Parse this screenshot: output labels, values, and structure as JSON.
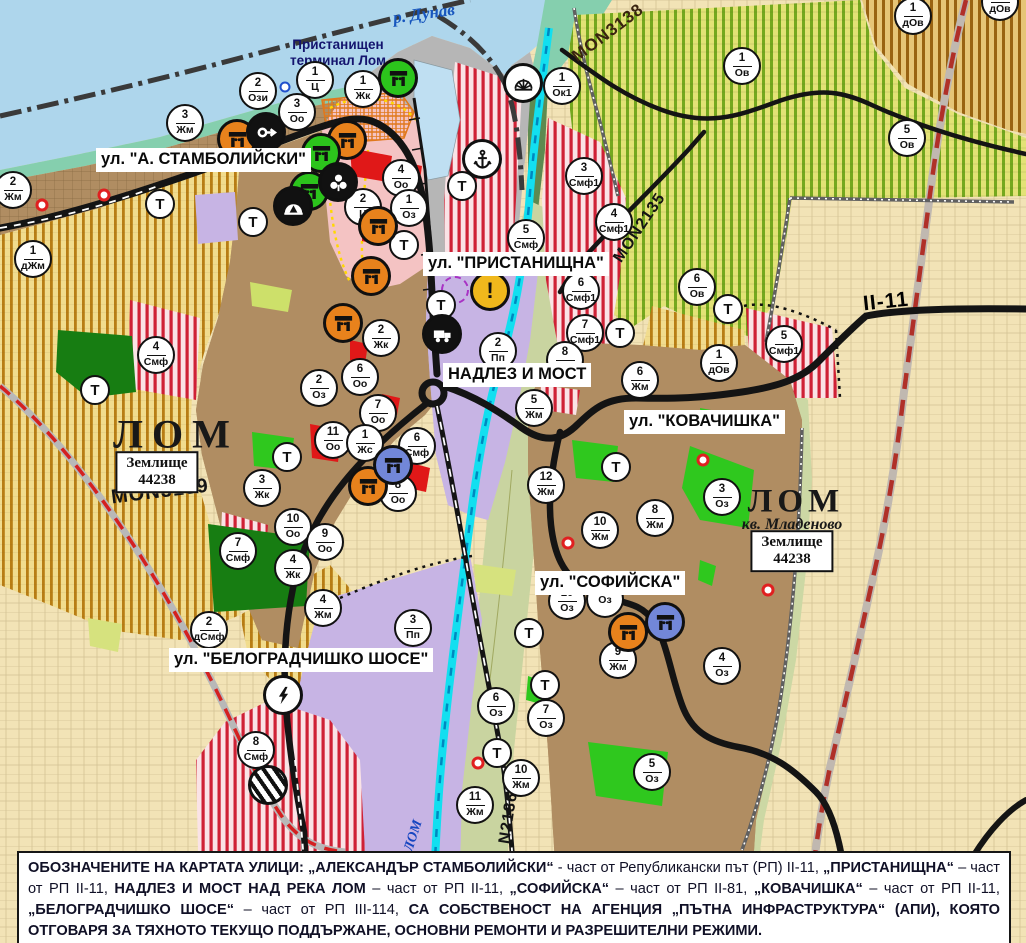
{
  "colors": {
    "water": "#aed6ec",
    "shore": "#85cfae",
    "port_gray": "#b6b6b6",
    "urban_brown": "#b08d62",
    "purple": "#c7b4e4",
    "beige": "#f2e3b6",
    "olive": "#c9d4a0",
    "cyan_river": "#12dff0",
    "red_patch": "#e01818",
    "green_patch": "#2fc81e",
    "dark_green": "#177d12",
    "marker_orange": "#e8821c",
    "marker_green": "#2cc41c",
    "marker_blue": "#7287d8",
    "marker_black": "#111111",
    "marker_yellow": "#f0b81c"
  },
  "water_labels": {
    "danube": "р. Дунав",
    "lom_river": "ЛОМ"
  },
  "labels": {
    "port_terminal": "Пристанищен\nтерминал Лом",
    "lom_left": "ЛОМ",
    "lom_right": "ЛОМ",
    "kv_mladenovo": "кв. Младеново",
    "zemlishte_line1": "Землище",
    "zemlishte_line2": "44238"
  },
  "street_labels": [
    {
      "id": "stamboliyski",
      "text": "ул. \"А. СТАМБОЛИЙСКИ\"",
      "x": 96,
      "y": 148
    },
    {
      "id": "pristanishtna",
      "text": "ул. \"ПРИСТАНИЩНА\"",
      "x": 423,
      "y": 252
    },
    {
      "id": "nadlez",
      "text": "НАДЛЕЗ И МОСТ",
      "x": 443,
      "y": 363
    },
    {
      "id": "kovachishka",
      "text": "ул. \"КОВАЧИШКА\"",
      "x": 624,
      "y": 410
    },
    {
      "id": "sofiyska",
      "text": "ул. \"СОФИЙСКА\"",
      "x": 535,
      "y": 571
    },
    {
      "id": "belogradchishko",
      "text": "ул. \"БЕЛОГРАДЧИШКО ШОСЕ\"",
      "x": 169,
      "y": 648
    }
  ],
  "road_labels": [
    {
      "text": "MON3138",
      "x": 608,
      "y": 33,
      "rot": -37,
      "size": 17,
      "color": "#3a2410"
    },
    {
      "text": "MON2135",
      "x": 640,
      "y": 228,
      "rot": -56,
      "size": 16,
      "color": "#141414"
    },
    {
      "text": "MON3139",
      "x": 160,
      "y": 492,
      "rot": -7,
      "size": 20,
      "color": "#141414"
    },
    {
      "text": "N2136",
      "x": 509,
      "y": 818,
      "rot": -81,
      "size": 16,
      "color": "#141414"
    },
    {
      "text": "II-11",
      "x": 886,
      "y": 302,
      "rot": -6,
      "size": 21,
      "color": "#000000"
    }
  ],
  "markers": {
    "t_label": "Т",
    "zones": [
      {
        "x": 258,
        "y": 91,
        "n": "2",
        "c": "Ози"
      },
      {
        "x": 315,
        "y": 80,
        "n": "1",
        "c": "Ц"
      },
      {
        "x": 297,
        "y": 112,
        "n": "3",
        "c": "Оо"
      },
      {
        "x": 363,
        "y": 89,
        "n": "1",
        "c": "Жк"
      },
      {
        "x": 185,
        "y": 123,
        "n": "3",
        "c": "Жм"
      },
      {
        "x": 13,
        "y": 190,
        "n": "2",
        "c": "Жм"
      },
      {
        "x": 33,
        "y": 259,
        "n": "1",
        "c": "дЖм"
      },
      {
        "x": 401,
        "y": 178,
        "n": "4",
        "c": "Оо"
      },
      {
        "x": 363,
        "y": 207,
        "n": "2",
        "c": "Ц"
      },
      {
        "x": 409,
        "y": 208,
        "n": "1",
        "c": "Оз"
      },
      {
        "x": 526,
        "y": 238,
        "n": "5",
        "c": "Смф"
      },
      {
        "x": 562,
        "y": 86,
        "n": "1",
        "c": "Ок1"
      },
      {
        "x": 584,
        "y": 176,
        "n": "3",
        "c": "Смф1"
      },
      {
        "x": 614,
        "y": 222,
        "n": "4",
        "c": "Смф1"
      },
      {
        "x": 742,
        "y": 66,
        "n": "1",
        "c": "Ов"
      },
      {
        "x": 913,
        "y": 16,
        "n": "1",
        "c": "дОв"
      },
      {
        "x": 1000,
        "y": 2,
        "n": "1",
        "c": "дОв"
      },
      {
        "x": 907,
        "y": 138,
        "n": "5",
        "c": "Ов"
      },
      {
        "x": 697,
        "y": 287,
        "n": "6",
        "c": "Ов"
      },
      {
        "x": 581,
        "y": 291,
        "n": "6",
        "c": "Смф1"
      },
      {
        "x": 585,
        "y": 333,
        "n": "7",
        "c": "Смф1"
      },
      {
        "x": 719,
        "y": 363,
        "n": "1",
        "c": "дОв"
      },
      {
        "x": 784,
        "y": 344,
        "n": "5",
        "c": "Смф1"
      },
      {
        "x": 498,
        "y": 351,
        "n": "2",
        "c": "Пп"
      },
      {
        "x": 565,
        "y": 360,
        "n": "8",
        "c": "Жм"
      },
      {
        "x": 534,
        "y": 408,
        "n": "5",
        "c": "Жм"
      },
      {
        "x": 640,
        "y": 380,
        "n": "6",
        "c": "Жм"
      },
      {
        "x": 381,
        "y": 338,
        "n": "2",
        "c": "Жк"
      },
      {
        "x": 360,
        "y": 377,
        "n": "6",
        "c": "Оо"
      },
      {
        "x": 319,
        "y": 388,
        "n": "2",
        "c": "Оз"
      },
      {
        "x": 378,
        "y": 413,
        "n": "7",
        "c": "Оо"
      },
      {
        "x": 333,
        "y": 440,
        "n": "11",
        "c": "Оо"
      },
      {
        "x": 365,
        "y": 443,
        "n": "1",
        "c": "Жс"
      },
      {
        "x": 417,
        "y": 446,
        "n": "6",
        "c": "Смф"
      },
      {
        "x": 398,
        "y": 493,
        "n": "8",
        "c": "Оо"
      },
      {
        "x": 262,
        "y": 488,
        "n": "3",
        "c": "Жк"
      },
      {
        "x": 293,
        "y": 527,
        "n": "10",
        "c": "Оо"
      },
      {
        "x": 325,
        "y": 542,
        "n": "9",
        "c": "Оо"
      },
      {
        "x": 293,
        "y": 568,
        "n": "4",
        "c": "Жк"
      },
      {
        "x": 238,
        "y": 551,
        "n": "7",
        "c": "Смф"
      },
      {
        "x": 156,
        "y": 355,
        "n": "4",
        "c": "Смф"
      },
      {
        "x": 546,
        "y": 485,
        "n": "12",
        "c": "Жм"
      },
      {
        "x": 600,
        "y": 530,
        "n": "10",
        "c": "Жм"
      },
      {
        "x": 655,
        "y": 518,
        "n": "8",
        "c": "Жм"
      },
      {
        "x": 722,
        "y": 497,
        "n": "3",
        "c": "Оз"
      },
      {
        "x": 323,
        "y": 608,
        "n": "4",
        "c": "Жм"
      },
      {
        "x": 209,
        "y": 630,
        "n": "2",
        "c": "дСмф"
      },
      {
        "x": 413,
        "y": 628,
        "n": "3",
        "c": "Пп"
      },
      {
        "x": 256,
        "y": 750,
        "n": "8",
        "c": "Смф"
      },
      {
        "x": 567,
        "y": 601,
        "n": "10",
        "c": "Оз"
      },
      {
        "x": 605,
        "y": 599,
        "n": "",
        "c": "Оз"
      },
      {
        "x": 618,
        "y": 660,
        "n": "9",
        "c": "Жм"
      },
      {
        "x": 722,
        "y": 666,
        "n": "4",
        "c": "Оз"
      },
      {
        "x": 496,
        "y": 706,
        "n": "6",
        "c": "Оз"
      },
      {
        "x": 546,
        "y": 718,
        "n": "7",
        "c": "Оз"
      },
      {
        "x": 521,
        "y": 778,
        "n": "10",
        "c": "Жм"
      },
      {
        "x": 475,
        "y": 805,
        "n": "11",
        "c": "Жм"
      },
      {
        "x": 652,
        "y": 772,
        "n": "5",
        "c": "Оз"
      }
    ],
    "t_points": [
      {
        "x": 160,
        "y": 204
      },
      {
        "x": 253,
        "y": 222
      },
      {
        "x": 404,
        "y": 245
      },
      {
        "x": 462,
        "y": 186
      },
      {
        "x": 441,
        "y": 305
      },
      {
        "x": 95,
        "y": 390
      },
      {
        "x": 287,
        "y": 457
      },
      {
        "x": 616,
        "y": 467
      },
      {
        "x": 620,
        "y": 333
      },
      {
        "x": 728,
        "y": 309
      },
      {
        "x": 529,
        "y": 633
      },
      {
        "x": 545,
        "y": 685
      },
      {
        "x": 497,
        "y": 753
      }
    ],
    "icons": [
      {
        "x": 237,
        "y": 139,
        "type": "dolmen",
        "bg": "#e8821c",
        "name": "monument-orange-icon"
      },
      {
        "x": 347,
        "y": 140,
        "type": "dolmen",
        "bg": "#e8821c",
        "name": "monument-orange-icon"
      },
      {
        "x": 378,
        "y": 226,
        "type": "dolmen",
        "bg": "#e8821c",
        "name": "monument-orange-icon"
      },
      {
        "x": 371,
        "y": 276,
        "type": "dolmen",
        "bg": "#e8821c",
        "name": "monument-orange-icon"
      },
      {
        "x": 343,
        "y": 323,
        "type": "dolmen",
        "bg": "#e8821c",
        "name": "monument-orange-icon"
      },
      {
        "x": 368,
        "y": 486,
        "type": "dolmen",
        "bg": "#e8821c",
        "name": "monument-orange-icon"
      },
      {
        "x": 628,
        "y": 632,
        "type": "dolmen",
        "bg": "#e8821c",
        "name": "monument-orange-icon"
      },
      {
        "x": 398,
        "y": 78,
        "type": "dolmen",
        "bg": "#2cc41c",
        "name": "monument-green-icon"
      },
      {
        "x": 321,
        "y": 153,
        "type": "dolmen",
        "bg": "#2cc41c",
        "name": "monument-green-icon"
      },
      {
        "x": 309,
        "y": 191,
        "type": "dolmen",
        "bg": "#2cc41c",
        "name": "monument-green-icon"
      },
      {
        "x": 393,
        "y": 465,
        "type": "dolmen",
        "bg": "#7287d8",
        "name": "monument-blue-icon"
      },
      {
        "x": 665,
        "y": 622,
        "type": "dolmen",
        "bg": "#7287d8",
        "name": "monument-blue-icon"
      },
      {
        "x": 266,
        "y": 132,
        "type": "key",
        "bg": "#111111",
        "name": "key-icon"
      },
      {
        "x": 338,
        "y": 182,
        "type": "trefoil",
        "bg": "#111111",
        "name": "trefoil-icon"
      },
      {
        "x": 293,
        "y": 206,
        "type": "cave",
        "bg": "#111111",
        "name": "cave-icon"
      },
      {
        "x": 442,
        "y": 334,
        "type": "truck",
        "bg": "#111111",
        "name": "truck-icon"
      },
      {
        "x": 482,
        "y": 159,
        "type": "anchor",
        "bg": "#ffffff",
        "name": "anchor-icon"
      },
      {
        "x": 523,
        "y": 83,
        "type": "sun",
        "bg": "#ffffff",
        "name": "sunrise-icon"
      },
      {
        "x": 490,
        "y": 291,
        "type": "excl",
        "bg": "#f0b81c",
        "name": "warning-icon"
      },
      {
        "x": 283,
        "y": 695,
        "type": "bolt",
        "bg": "#ffffff",
        "name": "lightning-icon"
      },
      {
        "x": 268,
        "y": 785,
        "type": "striped",
        "bg": "",
        "name": "striped-crossing-icon"
      }
    ],
    "dots": [
      {
        "x": 42,
        "y": 205,
        "type": "dotR"
      },
      {
        "x": 104,
        "y": 195,
        "type": "dotR"
      },
      {
        "x": 703,
        "y": 460,
        "type": "dotR"
      },
      {
        "x": 568,
        "y": 543,
        "type": "dotR"
      },
      {
        "x": 768,
        "y": 590,
        "type": "dotR"
      },
      {
        "x": 478,
        "y": 763,
        "type": "dotR"
      },
      {
        "x": 285,
        "y": 87,
        "type": "dotB"
      },
      {
        "x": 455,
        "y": 290,
        "type": "ringP"
      }
    ]
  },
  "note": {
    "segments": [
      {
        "text": "ОБОЗНАЧЕНИТЕ НА КАРТАТА УЛИЦИ: „АЛЕКСАНДЪР СТАМБОЛИЙСКИ“",
        "bold": true
      },
      {
        "text": " - част от Републикански път (РП) II-11, ",
        "bold": false
      },
      {
        "text": "„ПРИСТАНИЩНА“",
        "bold": true
      },
      {
        "text": " – част от РП II-11, ",
        "bold": false
      },
      {
        "text": "НАДЛЕЗ И МОСТ НАД РЕКА ЛОМ",
        "bold": true
      },
      {
        "text": " – част от РП II-11, ",
        "bold": false
      },
      {
        "text": "„СОФИЙСКА“",
        "bold": true
      },
      {
        "text": " – част от РП II-81, ",
        "bold": false
      },
      {
        "text": "„КОВАЧИШКА“",
        "bold": true
      },
      {
        "text": " – част от РП II-11, ",
        "bold": false
      },
      {
        "text": "„БЕЛОГРАДЧИШКО ШОСЕ“",
        "bold": true
      },
      {
        "text": " – част от РП III-114, ",
        "bold": false
      },
      {
        "text": "СА СОБСТВЕНОСТ НА АГЕНЦИЯ „ПЪТНА ИНФРАСТРУКТУРА“ (АПИ), КОЯТО ОТГОВАРЯ ЗА ТЯХНОТО ТЕКУЩО ПОДДЪРЖАНЕ, ОСНОВНИ РЕМОНТИ И РАЗРЕШИТЕЛНИ РЕЖИМИ.",
        "bold": true
      }
    ]
  }
}
